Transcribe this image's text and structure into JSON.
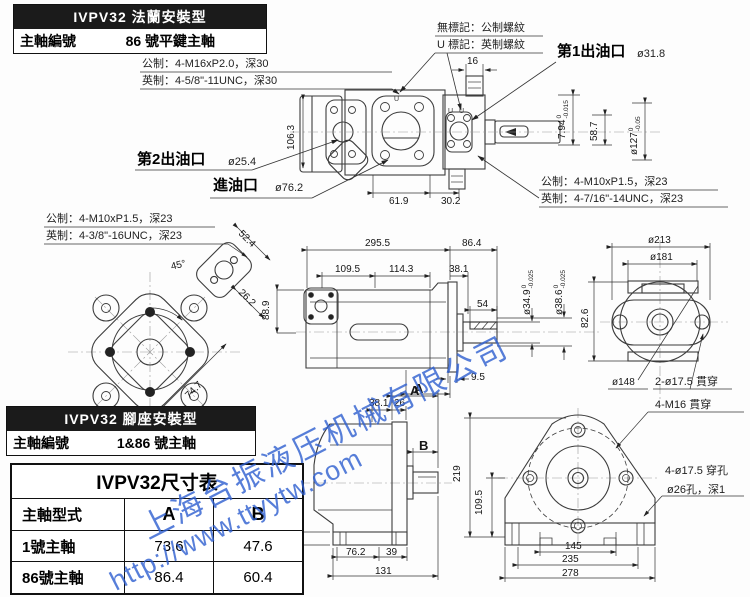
{
  "flange_header": {
    "title": "IVPV32 法蘭安裝型",
    "label": "主軸編號",
    "value": "86 號平鍵主軸"
  },
  "foot_header": {
    "title": "IVPV32 腳座安裝型",
    "label": "主軸編號",
    "value": "1&86 號主軸"
  },
  "notes": {
    "metric_top": "公制：4-M16xP2.0，深30",
    "inch_top": "英制：4-5/8\"-11UNC，深30",
    "no_mark": "無標記：公制螺紋",
    "u_mark": "U 標記：英制螺紋",
    "metric_left": "公制：4-M10xP1.5，深23",
    "inch_left": "英制：4-3/8\"-16UNC，深23",
    "metric_right": "公制：4-M10xP1.5，深23",
    "inch_right": "英制：4-7/16\"-14UNC，深23"
  },
  "ports": {
    "outlet1_label": "第1出油口",
    "outlet1_size": "ø31.8",
    "outlet2_label": "第2出油口",
    "outlet2_size": "ø25.4",
    "inlet_label": "進油口",
    "inlet_size": "ø76.2"
  },
  "misc": {
    "u": "U"
  },
  "top_view": {
    "d16": "16",
    "d106_3": "106.3",
    "d61_9": "61.9",
    "d30_2": "30.2",
    "d7_94": {
      "v": "7.94",
      "hi": "0",
      "lo": "-0.015"
    },
    "d58_7": "58.7",
    "d127": {
      "v": "ø127",
      "hi": "0",
      "lo": "-0.05"
    }
  },
  "left_view": {
    "d52_4": "52.4",
    "d26_2": "26.2",
    "d45": "45°",
    "d74_7": "74.7",
    "d88_9": "88.9"
  },
  "mid_view": {
    "d295_5": "295.5",
    "d86_4": "86.4",
    "d109_5": "109.5",
    "d114_3": "114.3",
    "d38_1": "38.1",
    "d54": "54",
    "d9_5": "9.5",
    "label_a": "A",
    "d34_9": {
      "v": "ø34.9",
      "hi": "0",
      "lo": "-0.025"
    },
    "d38_6": {
      "v": "ø38.6",
      "hi": "0",
      "lo": "-0.025"
    }
  },
  "right_view": {
    "d213": "ø213",
    "d181": "ø181",
    "d82_6": "82.6",
    "d148": "ø148",
    "holes": "2-ø17.5 貫穿"
  },
  "foot_side": {
    "label_a": "A",
    "label_b": "B",
    "d38_1": "38.1",
    "d26": "26",
    "d23": "23",
    "d76_2": "76.2",
    "d39": "39",
    "d131": "131"
  },
  "foot_front": {
    "d219": "219",
    "d109_5": "109.5",
    "d145": "145",
    "d235": "235",
    "d278": "278",
    "bolts": "4-M16 貫穿",
    "holes": "4-ø17.5 穿孔",
    "counterbore": "ø26孔，深1"
  },
  "table": {
    "title": "IVPV32尺寸表",
    "headers": [
      "主軸型式",
      "A",
      "B"
    ],
    "rows": [
      [
        "1號主軸",
        "73.6",
        "47.6"
      ],
      [
        "86號主軸",
        "86.4",
        "60.4"
      ]
    ]
  },
  "watermark": {
    "company": "上海台振液压机械有限公司",
    "url": "http://www.ttyytw.com",
    "color": "#2e5fd0"
  }
}
